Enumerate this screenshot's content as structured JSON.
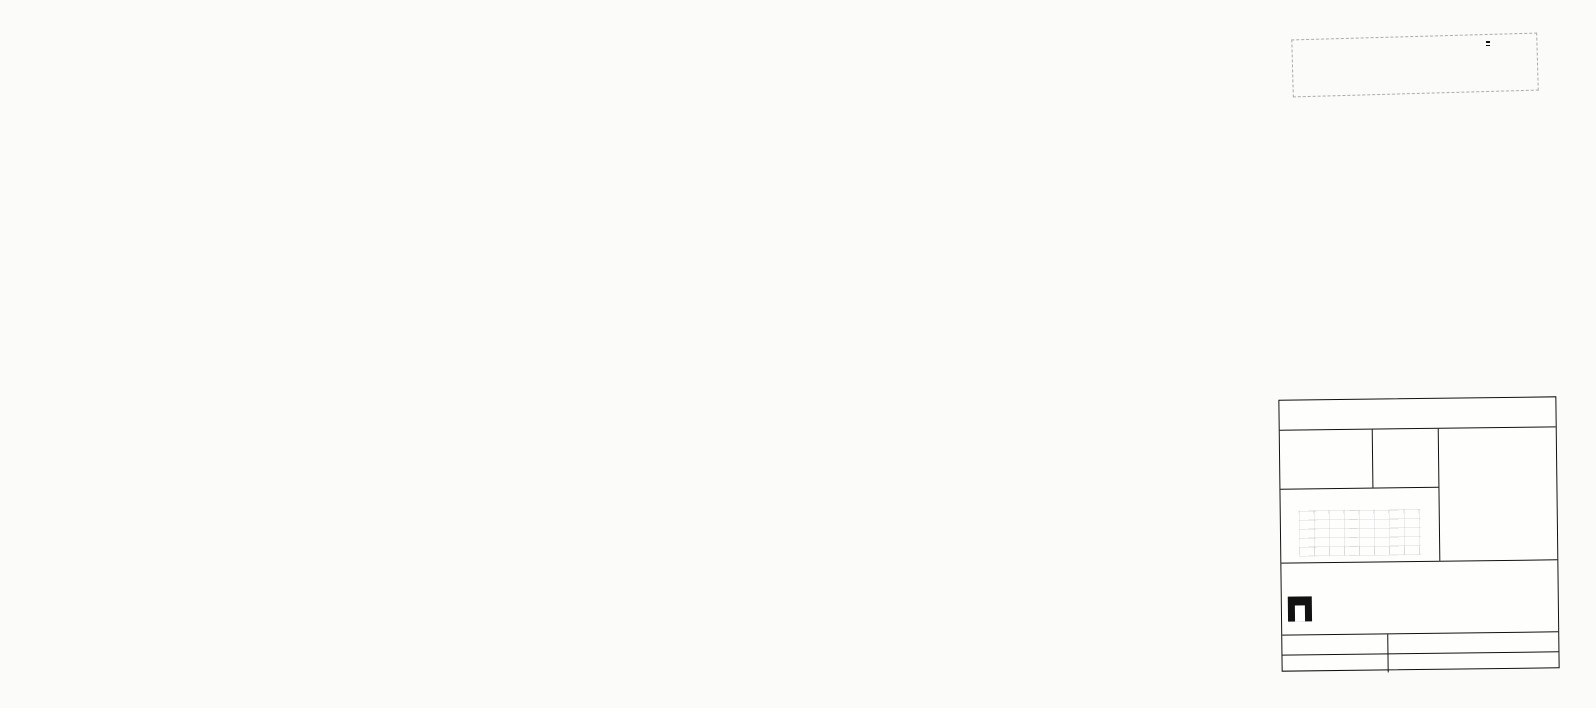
{
  "stamp": {
    "agency_line1": "ΥΠΟΥΡΓΕΙΟ ΧΩΡΟΤΑΞΙΑΣ",
    "agency_line2": "ΟΙΚΙΣΜΟΥ ΚΑΙ ΠΕΡΙΒΑΛΛΟΝΤΟΣ",
    "agency_line3": "ΕΠΙΧΕΙΡΗΣΗ ΠΟΛΕΟΔΟΜΙΚΗΣ ΑΝΑΣΥΓΚΡΟΤΗΣΗΣ",
    "epa_code": "Ε.Π.Α",
    "epa_years": "82-84"
  },
  "map": {
    "labels": [
      {
        "t": "ΜΕΣΟΝΥΧΙ",
        "x": 84,
        "y": 235,
        "fs": 15,
        "ls": 4
      },
      {
        "t": "ΤΟΠΙΚΟ ΕΜΠΟΡΙΚΟ ΚΕΝΤΡΟ-ΠΡΑΣΙΝΟ",
        "x": 344,
        "y": 197,
        "fs": 6,
        "rot": -7
      },
      {
        "t": "ΑΝΑΨΥΧΗ-ΕΞΥΠΗΡΕΤΗΣΕΙΣ-ΣΤΑΘΜΕΥΣΗ",
        "x": 346,
        "y": 209,
        "fs": 6,
        "rot": -7
      },
      {
        "t": "ΧΩΡΟΣ  ΓΙΑ",
        "x": 373,
        "y": 375,
        "fs": 6.5
      },
      {
        "t": "ΓΥΜΝΑΣΙΟ-ΛΥΚΕΙΟ",
        "x": 364,
        "y": 387,
        "fs": 6.5
      },
      {
        "t": "ΝΗΠΙΑΓΩΓΕΙΟ",
        "x": 276,
        "y": 588,
        "fs": 6.5
      },
      {
        "t": "ΠΑΙΔΙΚΗ ΧΑΡΑ",
        "x": 261,
        "y": 638,
        "fs": 6,
        "rot": -4
      },
      {
        "t": "ΟΔΙΚΟΣ-",
        "x": 252,
        "y": 648,
        "fs": 6
      },
      {
        "t": "ΣΤΑΘΜΟΣ",
        "x": 252,
        "y": 656,
        "fs": 6
      },
      {
        "t": "ΧΩΡΟΣ ΔΗΜΟ-",
        "x": 350,
        "y": 640,
        "fs": 6.5
      },
      {
        "t": "ΤΙΚΟΥ",
        "x": 355,
        "y": 650,
        "fs": 6.5
      },
      {
        "t": "ΣΧΟΛΕΙΟΥ",
        "x": 349,
        "y": 660,
        "fs": 6.5
      },
      {
        "t": "ΧΩΡΟΣ ΑΓΙΟΥ ΓΥΜΝΑΣΤΗΡΙΟΥ",
        "x": 764,
        "y": 618,
        "fs": 6.5
      },
      {
        "t": "ΕΜΠΟΡ.ΣΤΑΘΜΕΥΣΗ",
        "x": 769,
        "y": 629,
        "fs": 6.5
      },
      {
        "t": "ΠΑΡΚΟ",
        "x": 884,
        "y": 628,
        "fs": 7
      },
      {
        "t": "ΠΛ 20.00",
        "x": 468,
        "y": 194,
        "fs": 6,
        "rot": 40
      },
      {
        "t": "ΠΛ 20.00",
        "x": 758,
        "y": 426,
        "fs": 6,
        "rot": 40
      },
      {
        "t": "ΠΛ 30.00",
        "x": 688,
        "y": 648,
        "fs": 6,
        "rot": -90
      },
      {
        "t": "ΠΛ 15.00",
        "x": 262,
        "y": 516,
        "fs": 6,
        "rot": -50
      },
      {
        "t": "ΠΛ 16.00",
        "x": 334,
        "y": 545,
        "fs": 6
      },
      {
        "t": "ΠΛ 10.00",
        "x": 364,
        "y": 619,
        "fs": 5.5
      },
      {
        "t": "ΠΛ 10.00",
        "x": 486,
        "y": 655,
        "fs": 6
      },
      {
        "t": "ΠΛ 16.00",
        "x": 706,
        "y": 661,
        "fs": 6
      },
      {
        "t": "ΠΛ 10.00",
        "x": 598,
        "y": 638,
        "fs": 5.5,
        "rot": -90
      }
    ],
    "blocks": [
      {
        "t": "ΟΤ 01",
        "x": 390,
        "y": 222
      },
      {
        "t": "ΟΤ 02",
        "x": 292,
        "y": 350
      },
      {
        "t": "ΟΤ 03",
        "x": 290,
        "y": 430
      },
      {
        "t": "ΟΤ 06",
        "x": 390,
        "y": 361
      },
      {
        "t": "ΟΤ 07",
        "x": 534,
        "y": 431
      },
      {
        "t": "ΟΤ 08",
        "x": 698,
        "y": 508
      },
      {
        "t": "ΟΤ 09",
        "x": 706,
        "y": 644
      },
      {
        "t": "ΟΤ 10",
        "x": 628,
        "y": 613
      },
      {
        "t": "ΟΤ 12",
        "x": 408,
        "y": 626
      },
      {
        "t": "ΟΤ 13",
        "x": 348,
        "y": 592
      },
      {
        "t": "ΟΤ 14",
        "x": 214,
        "y": 563
      },
      {
        "t": "ΟΤ 15",
        "x": 294,
        "y": 592
      },
      {
        "t": "ΟΤ 16",
        "x": 289,
        "y": 623
      },
      {
        "t": "ΟΤ 19",
        "x": 498,
        "y": 613
      },
      {
        "t": "ΟΤ 20",
        "x": 465,
        "y": 666
      }
    ],
    "codes": [
      {
        "t": "Γ-300",
        "x": 396,
        "y": 236
      },
      {
        "t": "Γ-1043",
        "x": 394,
        "y": 352
      },
      {
        "t": "Γ-1291",
        "x": 545,
        "y": 424
      },
      {
        "t": "Γ-423",
        "x": 366,
        "y": 586
      },
      {
        "t": "Γ-1407",
        "x": 297,
        "y": 584
      },
      {
        "t": "Γ-1410",
        "x": 500,
        "y": 606
      },
      {
        "t": "Γ-1107",
        "x": 633,
        "y": 606
      },
      {
        "t": "Γ-1293",
        "x": 706,
        "y": 636
      }
    ],
    "letters": [
      {
        "t": "Π",
        "x": 515,
        "y": 362,
        "fs": 18
      },
      {
        "t": "Π",
        "x": 396,
        "y": 588,
        "fs": 20
      },
      {
        "t": "Π",
        "x": 565,
        "y": 592,
        "fs": 24
      },
      {
        "t": "Κ",
        "x": 576,
        "y": 646,
        "fs": 8,
        "box": true
      },
      {
        "t": "Κ",
        "x": 816,
        "y": 532,
        "fs": 8,
        "box": true
      },
      {
        "t": "Βε",
        "x": 520,
        "y": 424,
        "fs": 8
      },
      {
        "t": "Βδ",
        "x": 680,
        "y": 476,
        "fs": 8
      }
    ],
    "note": {
      "lines": [
        {
          "t": "Γ 64200/86 —Έγκριση",
          "x": 928,
          "y": 168,
          "fs": 8
        },
        {
          "t": "Πολεοδομικής μελέτης Τμήματος της",
          "x": 856,
          "y": 185,
          "fs": 7
        },
        {
          "t": "Πολεοδομικής Ενότητας «Λαθέα» του",
          "x": 854,
          "y": 196,
          "fs": 7
        },
        {
          "t": "Δήμου Αχαρνών",
          "x": 860,
          "y": 207,
          "fs": 7
        },
        {
          "t": "25 Σεπτεμβρίου 1986",
          "x": 914,
          "y": 230,
          "fs": 7.5
        },
        {
          "t": "Αθήνα",
          "x": 934,
          "y": 247,
          "fs": 7
        }
      ]
    }
  },
  "legend": {
    "entries": [
      {
        "sym": "bdash",
        "gr": "Όρια Πολεοδομικής Ενότητας - Γειτονιάς",
        "en": "City Planning Unit - Neighbourhood Boundary"
      },
      {
        "sym": "eee",
        "gr": "Όρια Κεντρικής Περιοχής",
        "en": "Central Area Boundary"
      },
      {
        "sym": "box",
        "box": "Π",
        "gr": "Όρια Πυκνοδομημένης Περιοχής",
        "en": "Densely Built Up Area Boundary"
      },
      {
        "sym": "solid",
        "gr": "Ρυμοτομικές Γραμμές (σχεδίου)",
        "en": "Street Line (plan)"
      },
      {
        "sym": "dash",
        "gr": "Οικοδομικές Γραμμές (σχεδίου)",
        "en": "Building Line Limit"
      },
      {
        "sym": "none",
        "gr": "Στοά",
        "en": "Arcade"
      },
      {
        "sym": "hook",
        "gr": "Ακάλυπτος Χώρος (σε κοινή χρήση)",
        "en": "Private Open Space (in common use)"
      },
      {
        "sym": "none",
        "gr": "Καταργούμενες Ρυμοτομικές ή Οικοδομικές Γραμμές",
        "en": "Abolished Street or Building Line"
      },
      {
        "sym": "box",
        "box": "Α",
        "gr": "Αμιγής Κατοικία",
        "en": "Residential"
      },
      {
        "sym": "box",
        "box": "",
        "gr": "Γενική Κατοικία",
        "en": "Mixed Residential"
      },
      {
        "sym": "box",
        "box": "Λ",
        "gr": "Λιανικό Εμπόριο, Εξυπηρετήσεις, Αναψυχή",
        "en": "Retail Trade, Services, Recreation"
      },
      {
        "sym": "box",
        "box": "Τ",
        "gr": "Τουρισμός",
        "en": "Tourism"
      },
      {
        "sym": "box",
        "box": "Οχ",
        "gr": "Μη Οχλούσα Βιομηχανία",
        "en": "Clean Area Light Manufacturing"
      },
      {
        "sym": "box",
        "box": "Χ",
        "gr": "Χονδρεμπόριο Βιομηχανία",
        "en": "Wholesale Trade"
      },
      {
        "sym": "box",
        "box": "Ολ",
        "gr": "Φυτώρια",
        "en": "Nursery"
      },
      {
        "sym": "box",
        "box": "Κ",
        "gr": "Ελεύθεροι Χώροι Κοινόχρηστοι",
        "en": "Public Open Space"
      },
      {
        "sym": "hatch",
        "gr": "Όρια Περιοχής Ανάπλασης",
        "en": "Boundary of Area Proposed to be Reformed"
      },
      {
        "sym": "cross",
        "gr": "Όρια Προστατευόμενων και Κηρυγμένων Αρχαιολογικών Χώρων",
        "en": "Boundary of Archaeological Site Proposed to be Listed"
      },
      {
        "sym": "coil",
        "gr": "Όρια προστατευόμενων και κηρυγμ. παραδοσιακών ή διατηρητέων Συνόλων",
        "en": "Boundary of Traditional or Preservation District Proposed to be Listed"
      },
      {
        "sym": "stars",
        "gr": "Όρια Περιοχής Προστατευόμενης για το Ιδιαίτερο Φυσικό της Κάλλος",
        "en": "Boundary of Area Proposed for its Special Natural Beauty"
      },
      {
        "ind": 1,
        "gr": "Βαθμός Προστασίας",
        "en": "Degree of Protection"
      },
      {
        "ind": 2,
        "sym": "dot",
        "gr": "Απόλυτη Προστασία",
        "en": "Absolute Protection"
      },
      {
        "ind": 2,
        "sym": "dot",
        "gr": "Μερική Προστασία",
        "en": "Partial Protection"
      },
      {
        "sym": "none",
        "gr": "Προστατευόμενα και Κηρυγμένα Μνημεία",
        "en": "Monument Proposed to be Listed"
      },
      {
        "sym": "tri",
        "gr": "Προστατευόμενα και Κηρυγμ. Αξιόλογα Αρχιτεκτονικά ή Φυσικά Στοιχεία",
        "en": "Element Proposed to be Listed for its Architectural or Natural Value"
      },
      {
        "sym": "none",
        "gr": "Προστατευόμενα και Κηρυγμ. Παραδοσιακά ή Διατηρητέα Κτίρια",
        "en": "Traditional or Requiring Preservation Building Proposed to be Listed"
      },
      {
        "ind": 1,
        "gr": "Βαθμός Προστασίας",
        "en": "Degree of Protection"
      },
      {
        "ind": 2,
        "sym": "dot",
        "gr": "Απόλυτη Προστασία",
        "en": "Absolute Protection"
      },
      {
        "ind": 1,
        "gr": "Προτεινόμενη Πεζοδρόμηση",
        "en": "Street Pedestrian"
      },
      {
        "ind": 1,
        "gr": "Προσόψεις Κτιρίων",
        "en": "Facades of Buildings Proposed to be Preserved"
      },
      {
        "ind": 1,
        "gr": "Ανώτατο Επιτρεπόμενο Ύψος Κτιρίων",
        "en": "Maximum Permitted Building Height"
      },
      {
        "sym": "bdots",
        "gr": "Όρια Ζώνης Συντελεστή Δόμησης (Σ.Δ.)",
        "en": "Maximum Floor Area Ratio Zones Boundary"
      },
      {
        "ind": 1,
        "gr": "Τομείς Συντελεστών Δόμησης",
        "en": "Floor Area Ratio Districts"
      },
      {
        "sym": "dots",
        "gr": "Όρια Τομέα Αρτίων - Όρων Δόμησης",
        "en": "Building Regulations District Boundary"
      },
      {
        "sym": "circ",
        "gr": "Όρια Τομέα Ειδικών Περιορισμών Δόμησης",
        "en": "Special Building Regulations District Boundary"
      },
      {
        "ind": 1,
        "gr": "Τομείς Αρτίων - Όρων Δόμησης",
        "en": "Other Building Regulations Districts"
      }
    ],
    "zones": [
      {
        "abbr": "Ζ.Κ.Σ",
        "gr": "Όρια Ζώνης Κοινωνικού Συντελεστή (Ζ.Κ.Σ.)",
        "en": "Social Coefficient Zone Boundary"
      },
      {
        "abbr": "Ζ.Α.Σ",
        "gr": "Όρια Ζώνης Αγοράς Συντελεστή (Ζ.Α.Σ.)",
        "en": "Floor Area Ratio Purchase Zone Boundary"
      },
      {
        "abbr": "Ζ.Ε.Κ",
        "gr": "Όρια Ζώνης Ειδικών Κινήτρων (Ζ.Ε.Κ.)",
        "en": "Special Incentives Zone Boundary"
      },
      {
        "abbr": "Ζ.Ε.Π",
        "gr": "Όρια Ζώνης Ενεργού Πολεοδομίας (Ζ.Ε.Π.)",
        "en": "Active Town Planning Zone Boundary"
      },
      {
        "abbr": "Ζ.Α.Α",
        "gr": "Όρια Ζώνης Αστικού Αναδασμού (Ζ.Α.Α.)",
        "en": "Urban Land Consolidation Zone Boundary"
      },
      {
        "abbr": "Ζ.Α.Ο",
        "gr": "Όρια Ζώνης Αναστολής Οικοδομών (Ζ.Α.Ο.)",
        "en": "Building Suspension Zone Boundary"
      },
      {
        "abbr": "Ζ.Ε.Ε",
        "gr": "Όρια Ζώνης Ειδικής Ενίσχυσης (Ζ.Ε.Ε.)",
        "en": "Special Reinforcement Zone Boundary"
      }
    ]
  },
  "title_block": {
    "title": "ΠΟΛΕΟΔΟΜΙΚΗ ΜΕΛΕΤΗ—",
    "subtitle_top": "ΑΝΑΘΕΩΡΗΣΗ",
    "subtitle_bottom": "ΕΠΕΚΤΑΣΗ",
    "center_label": "ΚΕΝΤΡΟΝ Φ.Χ. 1:100.000",
    "phi": "φ: 38°10′",
    "lambda": "λ: -0°16′",
    "photo_date_label1": "ΗΜΕΡΟΜΗΝΙΑ",
    "photo_date_label2": "ΦΩΤΟΛΗΨΙΑΣ",
    "photo_date_value": "1980",
    "team_header": "ΟΜΑΔΑ ΜΕΛΕΤΗΣ",
    "team": [
      {
        "name": "ΔΙΑΜΑΝΤΟΠΟΥΛΟΥ Α.",
        "role": "Αρχ. Πολεοδόμος"
      },
      {
        "name": "ΝΙΚΑ Η.",
        "role": "Αρχιτέκτων"
      },
      {
        "name": "ΜΠΑΛΙΑΣ Σ.",
        "role": "Αρχ. Πολεοδόμος"
      },
      {
        "name": "ΛΙΑΠΗ Δ.",
        "role": "Αρχ. Πολεοδόμος"
      },
      {
        "name": "ΘΕΟΔΩΡΟΥ Μ.",
        "role": "»"
      },
      {
        "name": "ΚΟΥΡΤΗ Ε.",
        "role": "»"
      },
      {
        "name": "ΣΑΜΠΩ Λ.",
        "role": "»"
      },
      {
        "name": "ΔΙΑΜΑΝΤΙΔΗ Χ.",
        "role": "»"
      },
      {
        "name": "ΤΣΕΚΟΥΡΑ Σ.",
        "role": "Πολ. Μηχανικός"
      },
      {
        "name": "ΣΤΑΘΑΚΟΠΟΥΛΟΥ Π.",
        "role": "Τοπογράφος"
      },
      {
        "name": "ΚΑΤΣΑΝΟΥ Δ.",
        "role": "»"
      },
      {
        "name": "ΚΑΖΑΝΤΖΗ Μ.",
        "role": "»"
      },
      {
        "name": "ΜΑΡΔΑ Ν.",
        "role": "»"
      },
      {
        "name": "ΡΩΤΑ Ε.",
        "role": "»"
      },
      {
        "name": "ΧΑΤΖΗ Φ.",
        "role": "»"
      }
    ],
    "team_extra": [
      {
        "name": "ΧΡΥΣΑΝΘΟΥ Τ.",
        "role": "Συνεργάτης ΥΧΟΠ"
      },
      {
        "name": "ΠΕΤΡΟΥ Ο.",
        "role": "Αρχ. της ΥΧΟΠ/ΔΠ"
      },
      {
        "name": "ΜΑΝΕΤΑ Μ.",
        "role": "Μηχανολόγος"
      }
    ],
    "sheet_index_label": "ΔΙΑΝΟΜΗ ΠΙΝΑΚΙΔΩΝ",
    "unit_label": "ΠΟΛΕΟΔΟΜΙΚΗ ΕΝΟΤΗΤΑ",
    "unit_name": "ΛΑΘΕΑΣ ΑΙ",
    "map_label": "ΧΑΡΤΗΣ",
    "map_code": "-21-22",
    "annotation": [
      "ΡΥΜΟΤΟΜΙΚΟ ΣΧΕΔΙΟ",
      "ΖΩΝΕΣ ΚΙΝΗΤΡΩΝ ΚΑΙ",
      "ΠΟΛΕΟΔΟΜΙΚΩΝ ΜΗΧΑΝΙΣΜΩΝ"
    ],
    "scale_label": "ΚΛΙΜΑΚΑ",
    "scale_value": "1: 1000",
    "date_value": "ΜΑΙΟΣ 1984",
    "municipality_label": "ΔΗΜΟΣ",
    "municipality": "ΑΧΑΡΝΩΝ",
    "prefecture_label": "ΝΟΜΟΣ",
    "prefecture": "ΑΤΤΙΚΗΣ",
    "phase": "Γ΄ΦΑΣΗ"
  }
}
